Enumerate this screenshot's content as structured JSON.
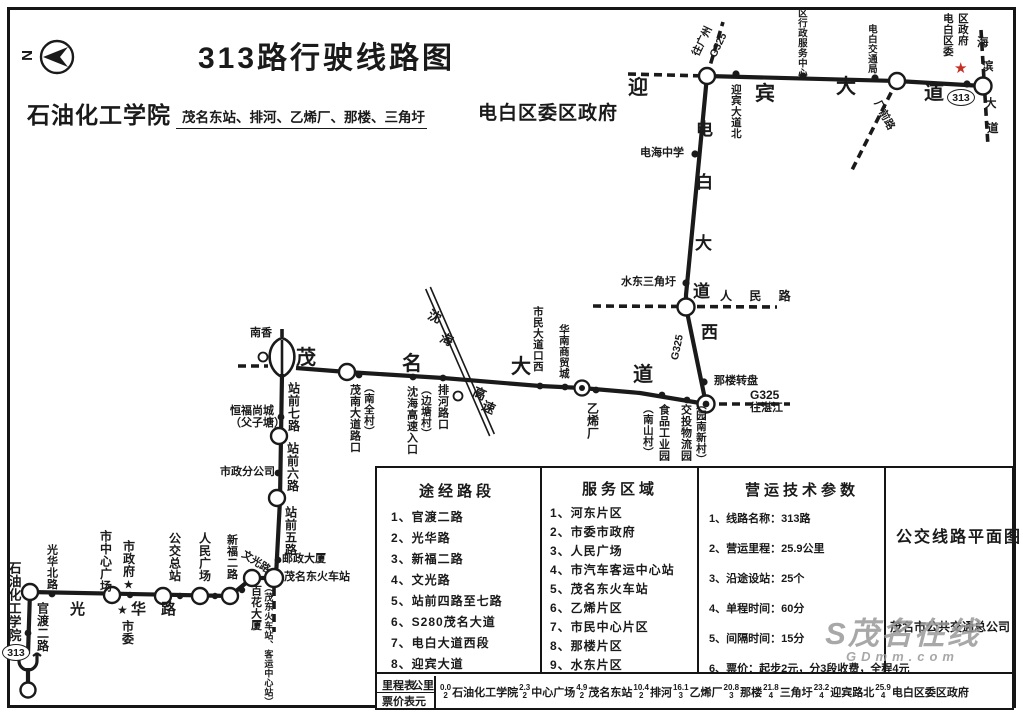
{
  "title": "313路行驶线路图",
  "subtitle": {
    "from": "石油化工学院",
    "via": "茂名东站、排河、乙烯厂、那楼、三角圩",
    "to": "电白区委区政府"
  },
  "compass_n": "N",
  "badge": "313",
  "star": "★",
  "map": {
    "roads": {
      "yingbin": [
        "迎",
        "宾",
        "大",
        "道"
      ],
      "dianbai": [
        "电",
        "白",
        "大",
        "道",
        "西"
      ],
      "maoming": [
        "茂",
        "名",
        "大",
        "道"
      ],
      "guanghua": [
        "光",
        "华",
        "路"
      ],
      "haibin": [
        "海",
        "滨",
        "大",
        "道"
      ],
      "shenhai": [
        "沈",
        "海",
        "高",
        "速"
      ],
      "renmin": "人 民 路",
      "g325": "G325",
      "to_guangzhou": "往广州",
      "to_zhanjiang": "往湛江",
      "changqian": "厂前路",
      "guandu": "官渡二路",
      "zhanqian7": "站前七路",
      "zhanqian6": "站前六路",
      "zhanqian5": "站前五路",
      "wenguang": "文光路"
    },
    "stops": {
      "yingbin_bei": "迎宾大道北",
      "qu_xingzheng_fuwu_zhongxin": "区行政服务中心",
      "dianbai_jiaotongju": "电白交通局",
      "dianbai_quwei": "电白区委",
      "quzhengfu": "区政府",
      "dianhai_zhongxue": "电海中学",
      "shuidong_sanjiaoxu": "水东三角圩",
      "nalou_zhuanpan": "那楼转盘",
      "jiaotou_wuliuyuan": "交投物流园",
      "yuannan_xincun": "（园南新村）",
      "shipin_gongyeyuan": "食品工业园",
      "nanshancun": "（南山村）",
      "yixichang": "乙烯厂",
      "huanan_shangmaocheng": "华南商贸城",
      "shimin_dadaokou_xi": "市民大道口西",
      "paihe_lukou": "排河路口",
      "shenhai_gaosu_rukou": "沈海高速入口",
      "biantangcun": "（边塘村）",
      "maonan_dadao_lukou": "茂南大道路口",
      "nanquancun": "（南全村）",
      "nanxiang": "南香",
      "hengfu_shangcheng": "恒福尚城",
      "fuzitang": "（父子塘）",
      "shizheng_fengongsi": "市政分公司",
      "youzheng_dasha": "邮政大厦",
      "maomingdong_huochezhan": "茂名东火车站",
      "baihua_dasha": "百花大厦",
      "maodong_keyun": "（茂东火车站、客运中心站）",
      "xinfu_erlu": "新福二路",
      "renmin_guangchang": "人民广场",
      "gongjiao_zongzhan": "公交总站",
      "shizhengfu": "市政府★",
      "shiwei": "市委",
      "shizhongxin_guangchang": "市中心广场",
      "guanghua_beilu": "光华北路",
      "shiyou_huagong_xueyuan": "石油化工学院"
    }
  },
  "table": {
    "col1": {
      "header": "途经路段",
      "items": [
        "1、官渡二路",
        "2、光华路",
        "3、新福二路",
        "4、文光路",
        "5、站前四路至七路",
        "6、S280茂名大道",
        "7、电白大道西段",
        "8、迎宾大道"
      ]
    },
    "col2": {
      "header": "服务区域",
      "items": [
        "1、河东片区",
        "2、市委市政府",
        "3、人民广场",
        "4、市汽车客运中心站",
        "5、茂名东火车站",
        "6、乙烯片区",
        "7、市民中心片区",
        "8、那楼片区",
        "9、水东片区"
      ]
    },
    "col3": {
      "header": "营运技术参数",
      "items": [
        "1、线路名称：313路",
        "2、营运里程：25.9公里",
        "3、沿途设站：25个",
        "4、单程时间：60分",
        "5、间隔时间：15分",
        "6、票价：起步2元，分3段收费，全程4元"
      ]
    },
    "col4": {
      "title": "公交线路平面图",
      "company": "茂名市公共交通总公司"
    },
    "fare": {
      "row1_label": "里程表",
      "row1_unit": "公里",
      "row2_label": "票价表",
      "row2_unit": "元",
      "segments": [
        {
          "km": "0.0",
          "fare": "2",
          "name": "石油化工学院"
        },
        {
          "km": "2.3",
          "fare": "2",
          "name": "中心广场"
        },
        {
          "km": "4.9",
          "fare": "2",
          "name": "茂名东站"
        },
        {
          "km": "10.4",
          "fare": "2",
          "name": "排河"
        },
        {
          "km": "16.1",
          "fare": "3",
          "name": "乙烯厂"
        },
        {
          "km": "20.8",
          "fare": "3",
          "name": "那楼"
        },
        {
          "km": "21.8",
          "fare": "4",
          "name": "三角圩"
        },
        {
          "km": "23.2",
          "fare": "4",
          "name": "迎宾路北"
        },
        {
          "km": "25.9",
          "fare": "4",
          "name": "电白区委区政府"
        }
      ]
    }
  },
  "watermark": {
    "logo": "S茂名在线",
    "domain": "GDmm.com"
  }
}
